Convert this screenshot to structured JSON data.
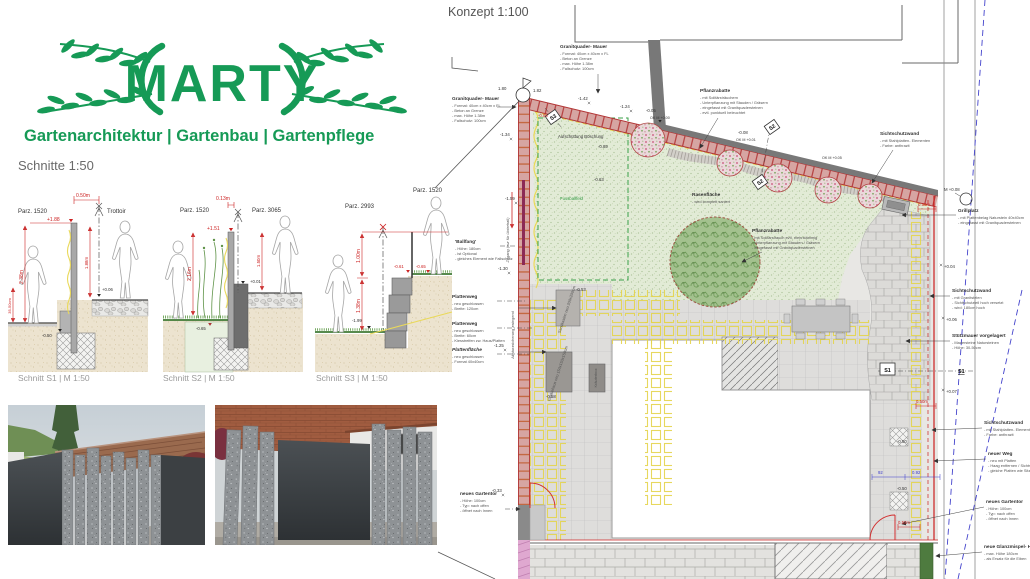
{
  "brand": {
    "logo_text": "MARTY",
    "tagline": "Gartenarchitektur | Gartenbau | Gartenpflege"
  },
  "colors": {
    "brand_green": "#169a56",
    "dim_red": "#cc2222",
    "boundary_red": "#b23636",
    "wall_band_pink": "#d6a5a2",
    "lawn_green": "#e2ebd6",
    "anthracite": "#3c4043"
  },
  "schnitte": {
    "heading": "Schnitte 1:50",
    "s1": {
      "caption": "Schnitt S1 | M 1:50",
      "parz_left": "Parz. 1520",
      "street": "Trottoir",
      "d_top": "0.50m",
      "e_top": "+1.88",
      "h1": "2.38m",
      "h2": "35-50cm",
      "h3": "1.88m",
      "e_mid": "+0.06",
      "e_low": "-0.50"
    },
    "s2": {
      "caption": "Schnitt S2 | M 1:50",
      "d_top": "0.13m",
      "parz_left": "Parz. 1520",
      "parz_right": "Parz. 3065",
      "e_top": "+1.51",
      "h1": "2.16m",
      "h2": "1.50m",
      "e_mid": "+0.01",
      "e_low": "-0.65"
    },
    "s3": {
      "caption": "Schnitt S3 | M 1:50",
      "parz_left": "Parz. 2993",
      "parz_right": "Parz. 1520",
      "h1": "1.00m",
      "h2": "1.38m",
      "e_a": "-0.61",
      "e_b": "-0.65",
      "e_low": "-1.99"
    }
  },
  "plan": {
    "title": "Konzept 1:100",
    "notes": {
      "mauer_top": {
        "title": "Granitquader- Mauer",
        "lines": [
          "- Format: 40cm x 40cm x FL",
          "- Beton an Grenze",
          "- max. Höhe 1.38m",
          "- Fallschutz: 100cm"
        ]
      },
      "mauer_left": {
        "title": "Granitquader- Mauer",
        "lines": [
          "- Format: 40cm x 40cm x FL",
          "- Beton an Grenze",
          "- max. Höhe 1.38m",
          "- Fallschutz: 100cm"
        ]
      },
      "pflanzrabatte_top": {
        "title": "Pflanzrabatte",
        "lines": [
          "- mit Solitärsträuchern",
          "- Unterpflanzung mit Stauden / Gräsern",
          "- eingefasst mit Granitquadersteinen",
          "- evtl. punktuell beleuchtet"
        ]
      },
      "pflanzrabatte_mitte": {
        "title": "Pflanzrabatte",
        "lines": [
          "- mit Solitärstrauch evtl. mehrstämmig",
          "- Unterpflanzung mit Stauden / Gräsern",
          "- eingefasst mit Granitquadersteinen"
        ]
      },
      "rasen": {
        "title": "Rasenfläche",
        "lines": [
          "- wird komplett saniert"
        ]
      },
      "aufschuettung": {
        "title": "Aufschüttung Böschung"
      },
      "fussballfeld": {
        "title": "Fussballfeld"
      },
      "sichtschutz_oben": {
        "title": "Sichtschutzwand",
        "lines": [
          "- mit Stahlplatten- Elementen",
          "- Farbe: anthrazit"
        ]
      },
      "grillplatz": {
        "title": "Grillplatz",
        "lines": [
          "- mit Plattenbelag Naturstein 40x40cm",
          "- eingefasst mit Granitquadersteinen"
        ]
      },
      "sichtschutz_mitte": {
        "title": "Sichtschutzwand",
        "lines": [
          "- mit Granitstelen",
          "- Sichtschutzteil hoch versetzt",
          "- wird: 180cm hoch"
        ]
      },
      "stuetzmauer": {
        "title": "Stützmauer vorgelagert",
        "lines": [
          "- Mauersteine Natursteinen",
          "- Höhe: 30-50cm"
        ]
      },
      "sichtschutz_unten": {
        "title": "Sichtschutzwand",
        "lines": [
          "- mit Stahlplatten- Elementen",
          "- Farbe: anthrazit"
        ]
      },
      "neuer_weg": {
        "title": "neuer Weg",
        "lines": [
          "- neu mit Platten",
          "- Haag entfernen / Sichtschutzwand",
          "- gleiche Platten wie Sitzplatz"
        ]
      },
      "gartentor_rechts": {
        "title": "neues Gartentor",
        "lines": [
          "- Höhe: 100cm",
          "- Typ: nach offen",
          "- öffnet nach Innen"
        ]
      },
      "hecke": {
        "title": "neue Glanzmispel- Hecke",
        "lines": [
          "- max. Höhe 180cm",
          "- als Ersatz für die Eiben"
        ]
      },
      "gartentor_links": {
        "title": "neues Gartentor",
        "lines": [
          "- Höhe: 100cm",
          "- Typ: nach offen",
          "- öffnet nach Innen"
        ]
      },
      "ballfang": {
        "title": "'Ballfang'",
        "lines": [
          "- Höhe: 180cm",
          "- ist Optional",
          "- gleiches Element wie Fallschutz"
        ]
      },
      "plattenweg1": {
        "title": "Plattenweg",
        "lines": [
          "- neu geschlossen",
          "- Breite: 120cm"
        ]
      },
      "plattenweg2": {
        "title": "Plattenweg",
        "lines": [
          "- neu geschlossen",
          "- Breite: 60cm",
          "- Kiesstreifen zw. Haus/Platten"
        ]
      },
      "plattenflaeche": {
        "title": "Plattenfläche",
        "lines": [
          "- neu geschlossen",
          "- Format 40x40cm"
        ]
      }
    },
    "rotlabels": {
      "sandkasten": "Sandkasten neu 200x200cm",
      "geraetehaus": "Gerätehaus neu 150x150x150cm",
      "kraeuterbox": "Kräuterbox",
      "absturz": "Absturzsicherung zwingend",
      "zugang": "Zugang (nur für Unterhalt)"
    },
    "levels": {
      "l085": "-0.85",
      "l134": "-1.34",
      "l142": "-1.42",
      "l124": "-1.24",
      "l005": "-0.05",
      "okm000": "OK M +0.00",
      "l008": "-0.08",
      "okm001": "OK M +0.01",
      "okm005": "OK M +0.05",
      "l089": "-0.89",
      "l063": "-0.63",
      "l159": "-1.59",
      "l130": "-1.30",
      "l125": "-1.25",
      "l053": "-0.53",
      "l058": "-0.58",
      "l033": "-0.33",
      "m008": "M +0.08",
      "p004": "+0.04",
      "p006": "+0.06",
      "p007": "+0.07",
      "l050": "-0.50",
      "c180": "1.80",
      "c182": "1.82"
    },
    "dims": {
      "d050": "0.50m",
      "d92": "92",
      "d092": "0.92"
    },
    "marks": {
      "s1": "S1",
      "s2": "S2",
      "s3": "S3"
    }
  }
}
